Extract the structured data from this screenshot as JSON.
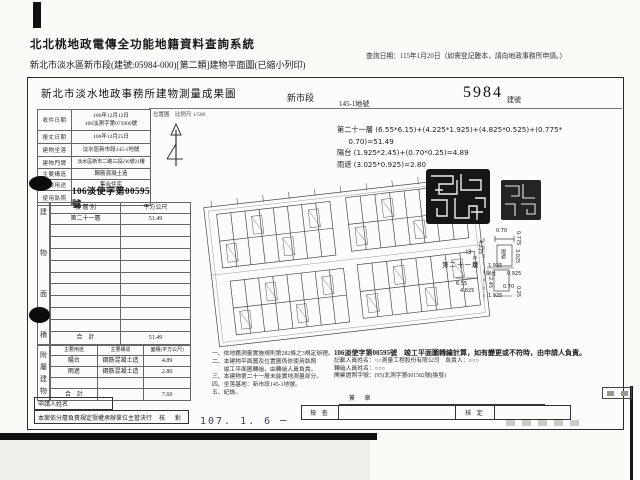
{
  "header": {
    "system_title": "北北桃地政電傳全功能地籍資料查詢系統",
    "query_date_note": "查詢日期：115年1月20日（如需登記謄本，請向地政事務所申請。）",
    "subtitle": "新北市淡水區新市段(建號:05984-000)[第二類]建物平面圖(已縮小列印)"
  },
  "document": {
    "title": "新北市淡水地政事務所建物測量成果圖",
    "section": "新市段",
    "land_no": "145-1地號",
    "building_no": "5984",
    "building_no_label": "建號",
    "map_label": "位置圖　比例尺 1/500",
    "info_rows": [
      {
        "label": "收件日期",
        "value": "106年12月12日",
        "value2": "106淡測字第073900號"
      },
      {
        "label": "複丈日期",
        "value": "106年12月25日"
      },
      {
        "label": "建物坐落",
        "value": "淡水區新市段145-1地號"
      },
      {
        "label": "建物門牌",
        "value": "淡水區新市二路三段236號21樓"
      },
      {
        "label": "主要構造",
        "value": "鋼筋混凝土造"
      },
      {
        "label": "主要用途",
        "value": "集合住宅"
      },
      {
        "label": "使用執照",
        "value": "106淡使字第00595號"
      }
    ],
    "floor_area_table": {
      "side_label": "建物面積",
      "headers": [
        "樓 層 別",
        "平方公尺"
      ],
      "rows": [
        [
          "第二十一層",
          "51.49"
        ]
      ],
      "empty_row_count": 9,
      "total_label": "合　計",
      "total": "51.49"
    },
    "annex_table": {
      "side_label": "附屬建物",
      "headers": [
        "主要用途",
        "主要構造",
        "面積(平方公尺)"
      ],
      "rows": [
        [
          "陽台",
          "鋼筋混凝土造",
          "4.89"
        ],
        [
          "雨遮",
          "鋼筋混凝土造",
          "2.80"
        ]
      ],
      "empty_row_count": 1,
      "total_label": "合　計",
      "total": "7.69"
    },
    "formulas": [
      "第二十一層 (6.55*6.15)+(4.225*1.925)+(4.825*0.525)+(0.775*",
      "     0.70)=51.49",
      "陽台 (1.925*2.45)+(0.70*0.25)=4.89",
      "雨遮 (3.025*0.925)=2.80"
    ],
    "notes_left": [
      "一、依地籍測量實施規則第282條之3規定辦理。",
      "二、本建物平面圖及位置圖係依使用執照",
      "　　竣工平面圖轉繪，由轉繪人員負責。",
      "三、本建物第二十一層未能實地測量部分。",
      "四、坐落基地：新市段145-1地號。",
      "五、紀錄。"
    ],
    "notes_right": [
      "106淡使字第00595號　竣工平面圖轉繪計算，如有變更或不符時，由申請人負責。",
      "記載人員姓名：○○測量工程股份有限公司　負責人：○○○",
      "轉繪人員姓名：○○○",
      "開業證照字號：(95)北測字第001582號(換發)"
    ],
    "detail_plan": {
      "unit_id": "I3",
      "floor_label": "第二十一層",
      "labels": [
        {
          "t": "0.70",
          "x": 496,
          "y": 229
        },
        {
          "t": "0.775",
          "x": 515,
          "y": 231,
          "v": 1
        },
        {
          "t": "4.225",
          "x": 477,
          "y": 240,
          "v": 1
        },
        {
          "t": "6.15",
          "x": 471,
          "y": 256,
          "v": 1
        },
        {
          "t": "雨遮",
          "x": 500,
          "y": 249,
          "v": 1,
          "cjk": 1
        },
        {
          "t": "3.025",
          "x": 514,
          "y": 249,
          "v": 1
        },
        {
          "t": "1.925",
          "x": 488,
          "y": 264
        },
        {
          "t": "陽台",
          "x": 486,
          "y": 272,
          "cjk": 1
        },
        {
          "t": "0.925",
          "x": 507,
          "y": 272
        },
        {
          "t": "2.45",
          "x": 487,
          "y": 277,
          "v": 1
        },
        {
          "t": "0.70",
          "x": 503,
          "y": 285
        },
        {
          "t": "0.25",
          "x": 515,
          "y": 286,
          "v": 1
        },
        {
          "t": "1.925",
          "x": 488,
          "y": 294
        },
        {
          "t": "6.55",
          "x": 456,
          "y": 282
        },
        {
          "t": "4.825",
          "x": 460,
          "y": 289
        }
      ]
    },
    "footer": {
      "applicant_label": "申請人姓名",
      "approval_text": "本案依分層負責規定授權承辦單位主管決行",
      "check_label": "核　對",
      "date_stamp": "107.  1.  6 ─",
      "sign_label": "簽 章",
      "inspect_label": "檢 查",
      "approve_label": "核 定"
    }
  }
}
